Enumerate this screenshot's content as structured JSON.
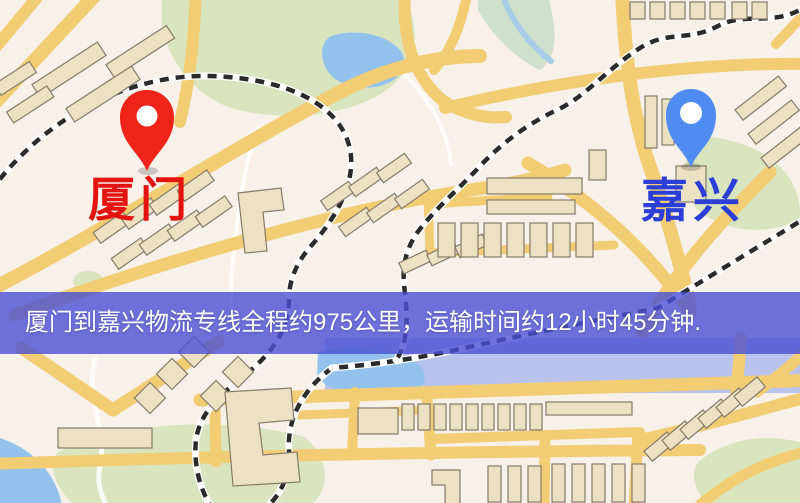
{
  "map": {
    "origin": {
      "label": "厦门"
    },
    "destination": {
      "label": "嘉兴"
    }
  },
  "banner": {
    "text": "厦门到嘉兴物流专线全程约975公里，运输时间约12小时45分钟."
  },
  "icons": {
    "origin_pin": "red-location-pin-icon",
    "destination_pin": "blue-location-pin-icon"
  },
  "colors": {
    "map_bg": "#f7f1e9",
    "road": "#f2cd74",
    "park": "#d8e5bf",
    "water": "#93c2ec",
    "building": "#ece1c2",
    "railway": "#2b2b2b",
    "origin_pin": "#ee2418",
    "origin_label": "#e31410",
    "destination_pin": "#4f8cf2",
    "destination_label": "#2b3fd6",
    "banner_bg": "#4a50d4",
    "banner_text": "#ffffff"
  }
}
